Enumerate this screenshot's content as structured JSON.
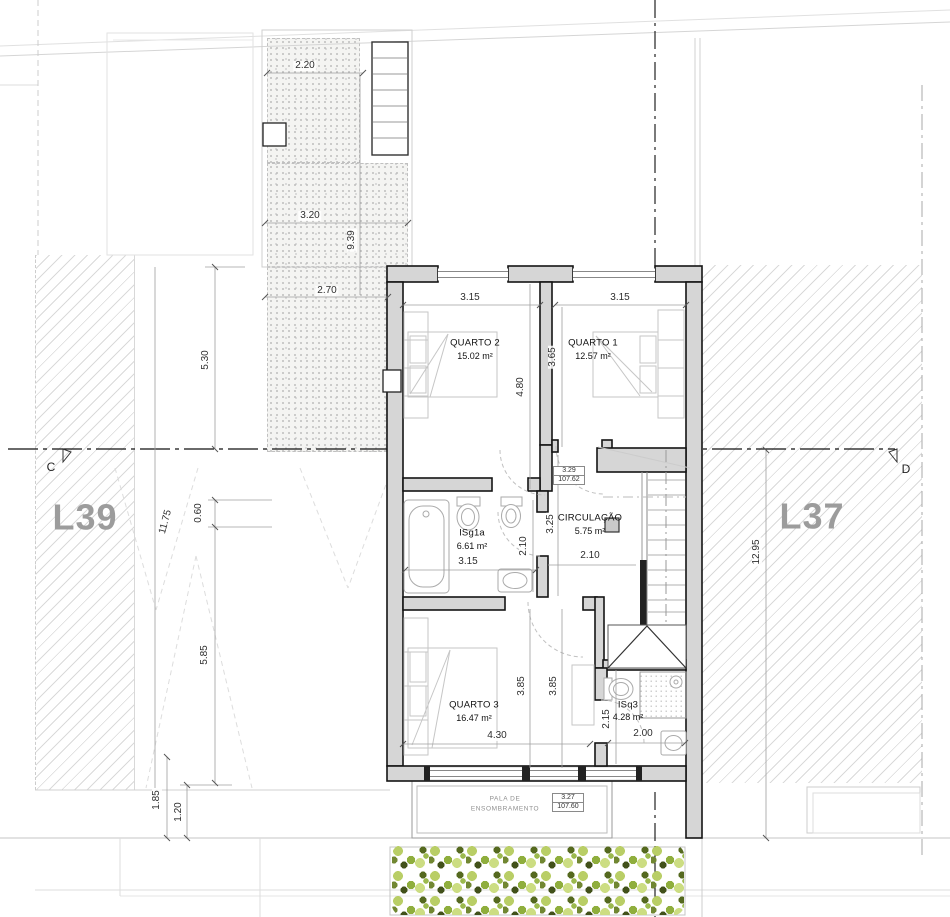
{
  "title": "First floor plan - semi-detached house",
  "lots": {
    "left": "L39",
    "right": "L37"
  },
  "section": {
    "left": "C",
    "right": "D"
  },
  "rooms": {
    "quarto2": {
      "name": "QUARTO 2",
      "area": "15.02 m²"
    },
    "quarto1": {
      "name": "QUARTO 1",
      "area": "12.57 m²"
    },
    "quarto3": {
      "name": "QUARTO 3",
      "area": "16.47 m²"
    },
    "circulacao": {
      "name": "CIRCULAÇÃO",
      "area": "5.75 m²"
    },
    "isg1a": {
      "name": "ISg1a",
      "area": "6.61 m²"
    },
    "isq3": {
      "name": "ISq3",
      "area": "4.28 m²"
    }
  },
  "levels": {
    "upper_value": "3.29",
    "upper_elev": "107.62",
    "lower_value": "3.27",
    "lower_elev": "107.60"
  },
  "canopy": {
    "line1": "PALA DE",
    "line2": "ENSOMBRAMENTO"
  },
  "dims": {
    "d220": "2.20",
    "d320": "3.20",
    "d939": "9.39",
    "d270": "2.70",
    "q2w": "3.15",
    "q1w": "3.15",
    "q1h": "3.65",
    "q2h": "4.80",
    "l530": "5.30",
    "l1175": "11.75",
    "l060": "0.60",
    "l585": "5.85",
    "l185": "1.85",
    "l120": "1.20",
    "bathw": "3.15",
    "bathh": "2.10",
    "circh": "3.25",
    "circw": "2.10",
    "q3ha": "3.85",
    "q3hb": "3.85",
    "q3w": "4.30",
    "isq3h": "2.15",
    "isq3w": "2.00",
    "r1295": "12.95"
  },
  "colors": {
    "wall_fill": "#d6d6d6",
    "wall_line": "#141414",
    "dim_line": "#9f9f9f",
    "lot_label": "#9c9c9c",
    "hedge_light": "#ccdd82",
    "hedge_mid": "#8fae3d",
    "hedge_dark": "#42511a"
  }
}
